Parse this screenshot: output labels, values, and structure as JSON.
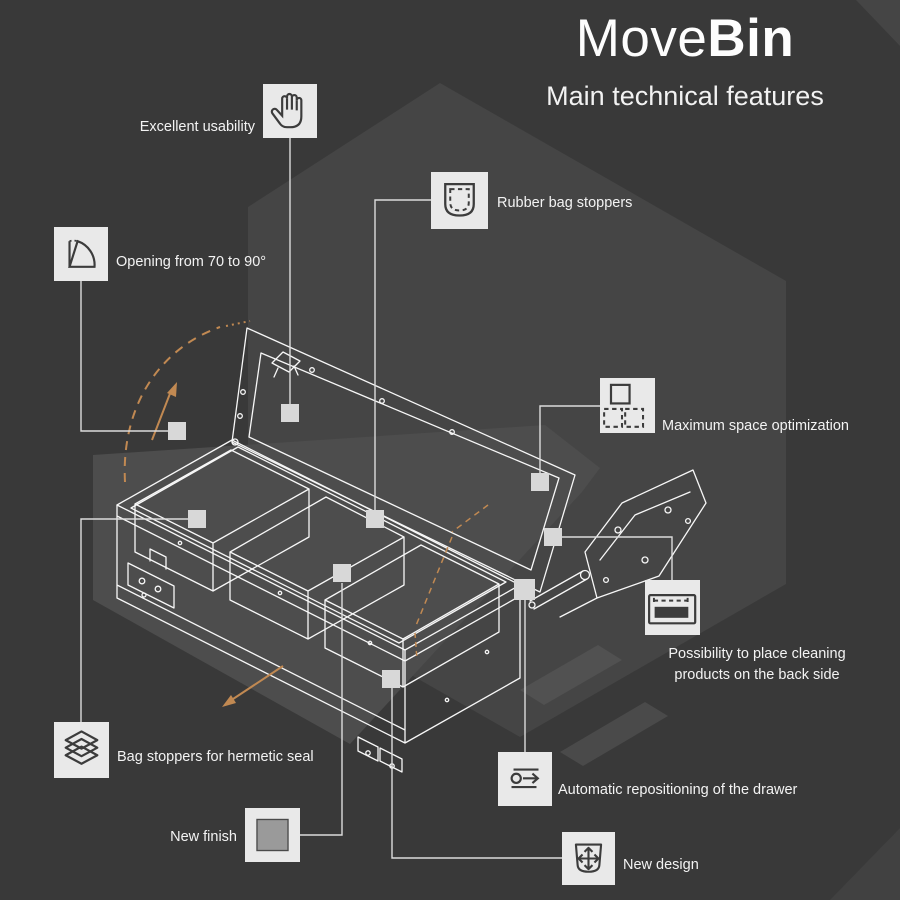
{
  "header": {
    "brand_regular": "Move",
    "brand_bold": "Bin",
    "subtitle": "Main technical features"
  },
  "features": [
    {
      "id": "usability",
      "label": "Excellent usability",
      "icon": "hand-icon"
    },
    {
      "id": "rubber-stoppers",
      "label": "Rubber bag stoppers",
      "icon": "bag-pocket-icon"
    },
    {
      "id": "opening-angle",
      "label": "Opening from 70 to 90°",
      "icon": "angle-arc-icon"
    },
    {
      "id": "space-optimization",
      "label": "Maximum space optimization",
      "icon": "grid-squares-icon"
    },
    {
      "id": "cleaning-products",
      "label": "Possibility to place cleaning products on the back side",
      "icon": "shelf-products-icon"
    },
    {
      "id": "hermetic-seal",
      "label": "Bag stoppers for hermetic seal",
      "icon": "layers-icon"
    },
    {
      "id": "auto-reposition",
      "label": "Automatic repositioning of the drawer",
      "icon": "slide-arrow-icon"
    },
    {
      "id": "new-finish",
      "label": "New finish",
      "icon": "finish-swatch-icon"
    },
    {
      "id": "new-design",
      "label": "New design",
      "icon": "bin-arrows-icon"
    }
  ],
  "colors": {
    "background": "#393939",
    "hexagon": "#454545",
    "wedge": "#4d4d4d",
    "icon_box": "#e9e9e9",
    "icon_stroke": "#3c3c3c",
    "line_art": "#f7f7f7",
    "connector": "#dcdcdc",
    "marker": "#d8d8d8",
    "accent_orange": "#c18952",
    "text": "#f3f3f3"
  }
}
